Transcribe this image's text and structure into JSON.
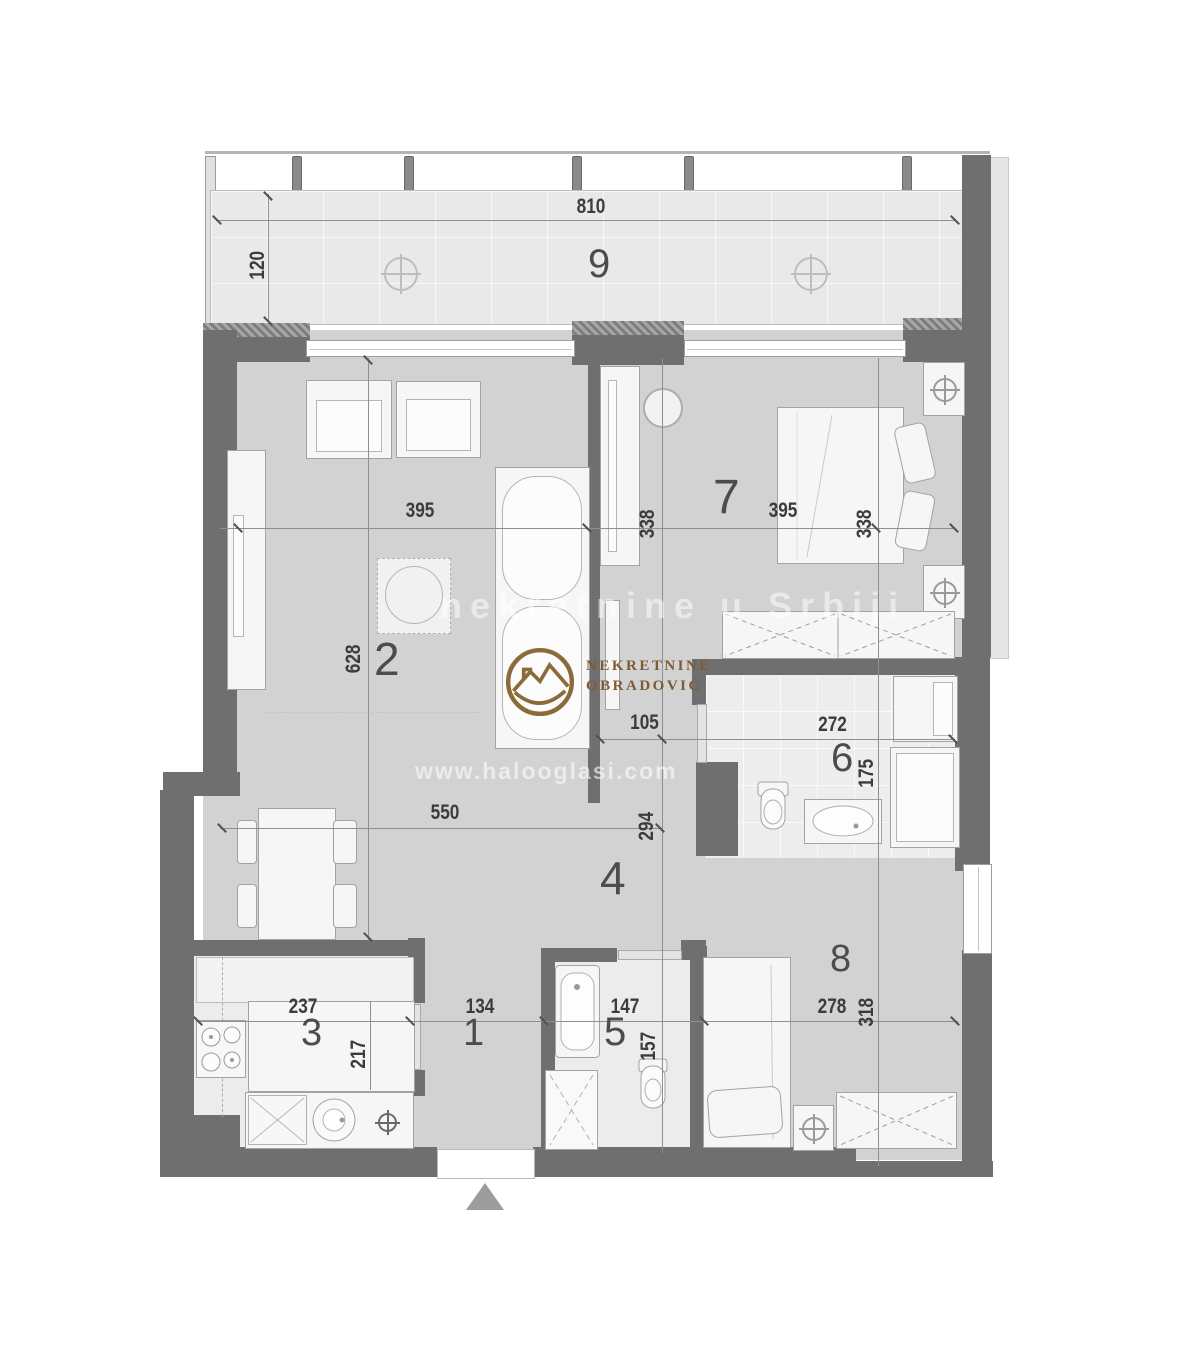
{
  "title": "Apartment floor plan",
  "rooms": {
    "hallway1": "1",
    "living": "2",
    "kitchen": "3",
    "hall4": "4",
    "bathroom5": "5",
    "bathroom6": "6",
    "bedroom7": "7",
    "bedroom8": "8",
    "terrace9": "9"
  },
  "dimensions": {
    "balcony": {
      "width": "810",
      "depth": "120"
    },
    "living_room": {
      "width": "395",
      "height": "628"
    },
    "corridor": {
      "height": "338",
      "width": "105"
    },
    "bedroom7": {
      "width": "395",
      "height": "338"
    },
    "hall": {
      "width": "550",
      "height": "294"
    },
    "bathroom6": {
      "width": "272",
      "height": "175"
    },
    "kitchen": {
      "width": "237",
      "height": "217"
    },
    "hallway1": {
      "width": "134"
    },
    "bathroom5": {
      "width": "147",
      "height": "157"
    },
    "bedroom8": {
      "width": "278",
      "height": "318"
    }
  },
  "watermark": {
    "brand_line1": "NEKRETNINE",
    "brand_line2": "OBRADOVIĆ",
    "faint_band": "nekretnine u Srbiji",
    "faint_url": "www.halooglasi.com"
  },
  "colors": {
    "wall": "#6f6f6f",
    "floor": "#d2d2d2",
    "tile_floor": "#ededed",
    "balcony_floor": "#e9e9e9",
    "logo_brown": "#8c6b3a",
    "dim_text": "#3c3c3c"
  }
}
